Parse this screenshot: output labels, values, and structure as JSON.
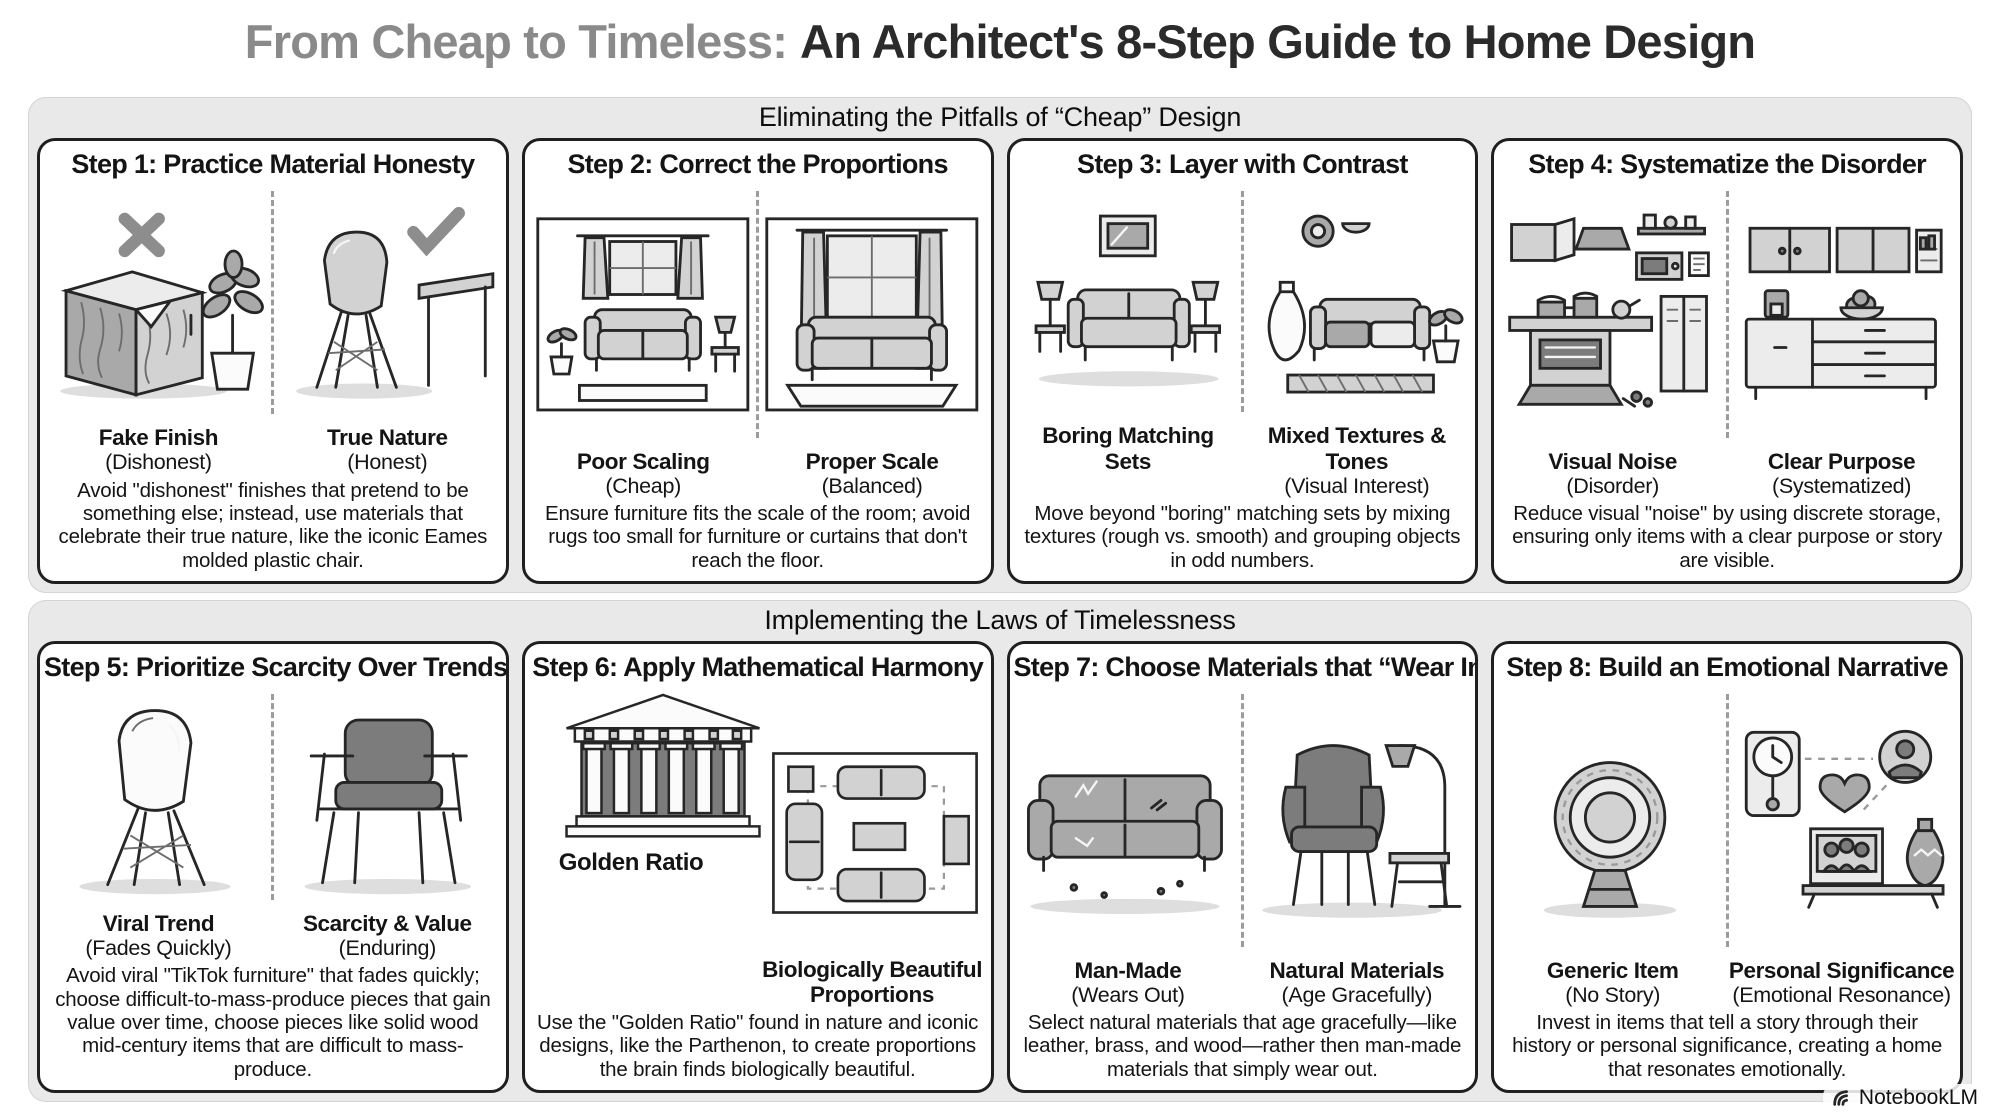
{
  "colors": {
    "title_gray": "#8a8a8a",
    "ink": "#2b2b2b",
    "section_bg": "#e9e9e9",
    "card_border": "#1f1f1f"
  },
  "title": {
    "muted": "From Cheap to Timeless:",
    "main": "An Architect's 8-Step Guide to Home Design"
  },
  "footer": {
    "brand": "NotebookLM"
  },
  "sections": [
    {
      "header": "Eliminating the Pitfalls of “Cheap” Design",
      "cards": [
        {
          "title": "Step 1: Practice Material Honesty",
          "left": {
            "label": "Fake Finish",
            "sublabel": "(Dishonest)"
          },
          "right": {
            "label": "True Nature",
            "sublabel": "(Honest)"
          },
          "description": "Avoid \"dishonest\" finishes that pretend to be something else; instead, use materials that celebrate their true nature, like the iconic Eames molded plastic chair."
        },
        {
          "title": "Step 2: Correct the Proportions",
          "left": {
            "label": "Poor Scaling",
            "sublabel": "(Cheap)"
          },
          "right": {
            "label": "Proper Scale",
            "sublabel": "(Balanced)"
          },
          "description": "Ensure furniture fits the scale of the room; avoid rugs too small for furniture or curtains that don't reach the floor."
        },
        {
          "title": "Step 3: Layer with Contrast",
          "left": {
            "label": "Boring Matching",
            "sublabel": "Sets"
          },
          "right": {
            "label": "Mixed Textures & Tones",
            "sublabel": "(Visual Interest)"
          },
          "description": "Move beyond \"boring\" matching sets by mixing textures (rough vs. smooth) and grouping objects in odd numbers."
        },
        {
          "title": "Step 4: Systematize the Disorder",
          "left": {
            "label": "Visual Noise",
            "sublabel": "(Disorder)"
          },
          "right": {
            "label": "Clear Purpose",
            "sublabel": "(Systematized)"
          },
          "description": "Reduce visual \"noise\" by using discrete storage, ensuring only items with a clear purpose or story are visible."
        }
      ]
    },
    {
      "header": "Implementing the Laws of Timelessness",
      "cards": [
        {
          "title": "Step 5: Prioritize Scarcity Over Trends",
          "left": {
            "label": "Viral Trend",
            "sublabel": "(Fades Quickly)"
          },
          "right": {
            "label": "Scarcity & Value",
            "sublabel": "(Enduring)"
          },
          "description": "Avoid viral \"TikTok furniture\" that fades quickly; choose difficult-to-mass-produce pieces that gain value over time, choose pieces like solid wood mid-century items that are difficult to mass-produce."
        },
        {
          "title": "Step 6: Apply Mathematical Harmony",
          "left": {
            "label": "Golden Ratio",
            "sublabel": ""
          },
          "right": {
            "label": "Biologically Beautiful",
            "sublabel": "Proportions"
          },
          "description": "Use the \"Golden Ratio\" found in nature and iconic designs, like the Parthenon, to create proportions the brain finds biologically beautiful."
        },
        {
          "title": "Step 7: Choose Materials that “Wear In”",
          "left": {
            "label": "Man-Made",
            "sublabel": "(Wears Out)"
          },
          "right": {
            "label": "Natural Materials",
            "sublabel": "(Age Gracefully)"
          },
          "description": "Select natural materials that age gracefully—like leather, brass, and wood—rather then man-made materials that simply wear out."
        },
        {
          "title": "Step 8: Build an Emotional Narrative",
          "left": {
            "label": "Generic Item",
            "sublabel": "(No Story)"
          },
          "right": {
            "label": "Personal Significance",
            "sublabel": "(Emotional Resonance)"
          },
          "description": "Invest in items that tell a story through their history or personal significance, creating a home that resonates emotionally."
        }
      ]
    }
  ]
}
